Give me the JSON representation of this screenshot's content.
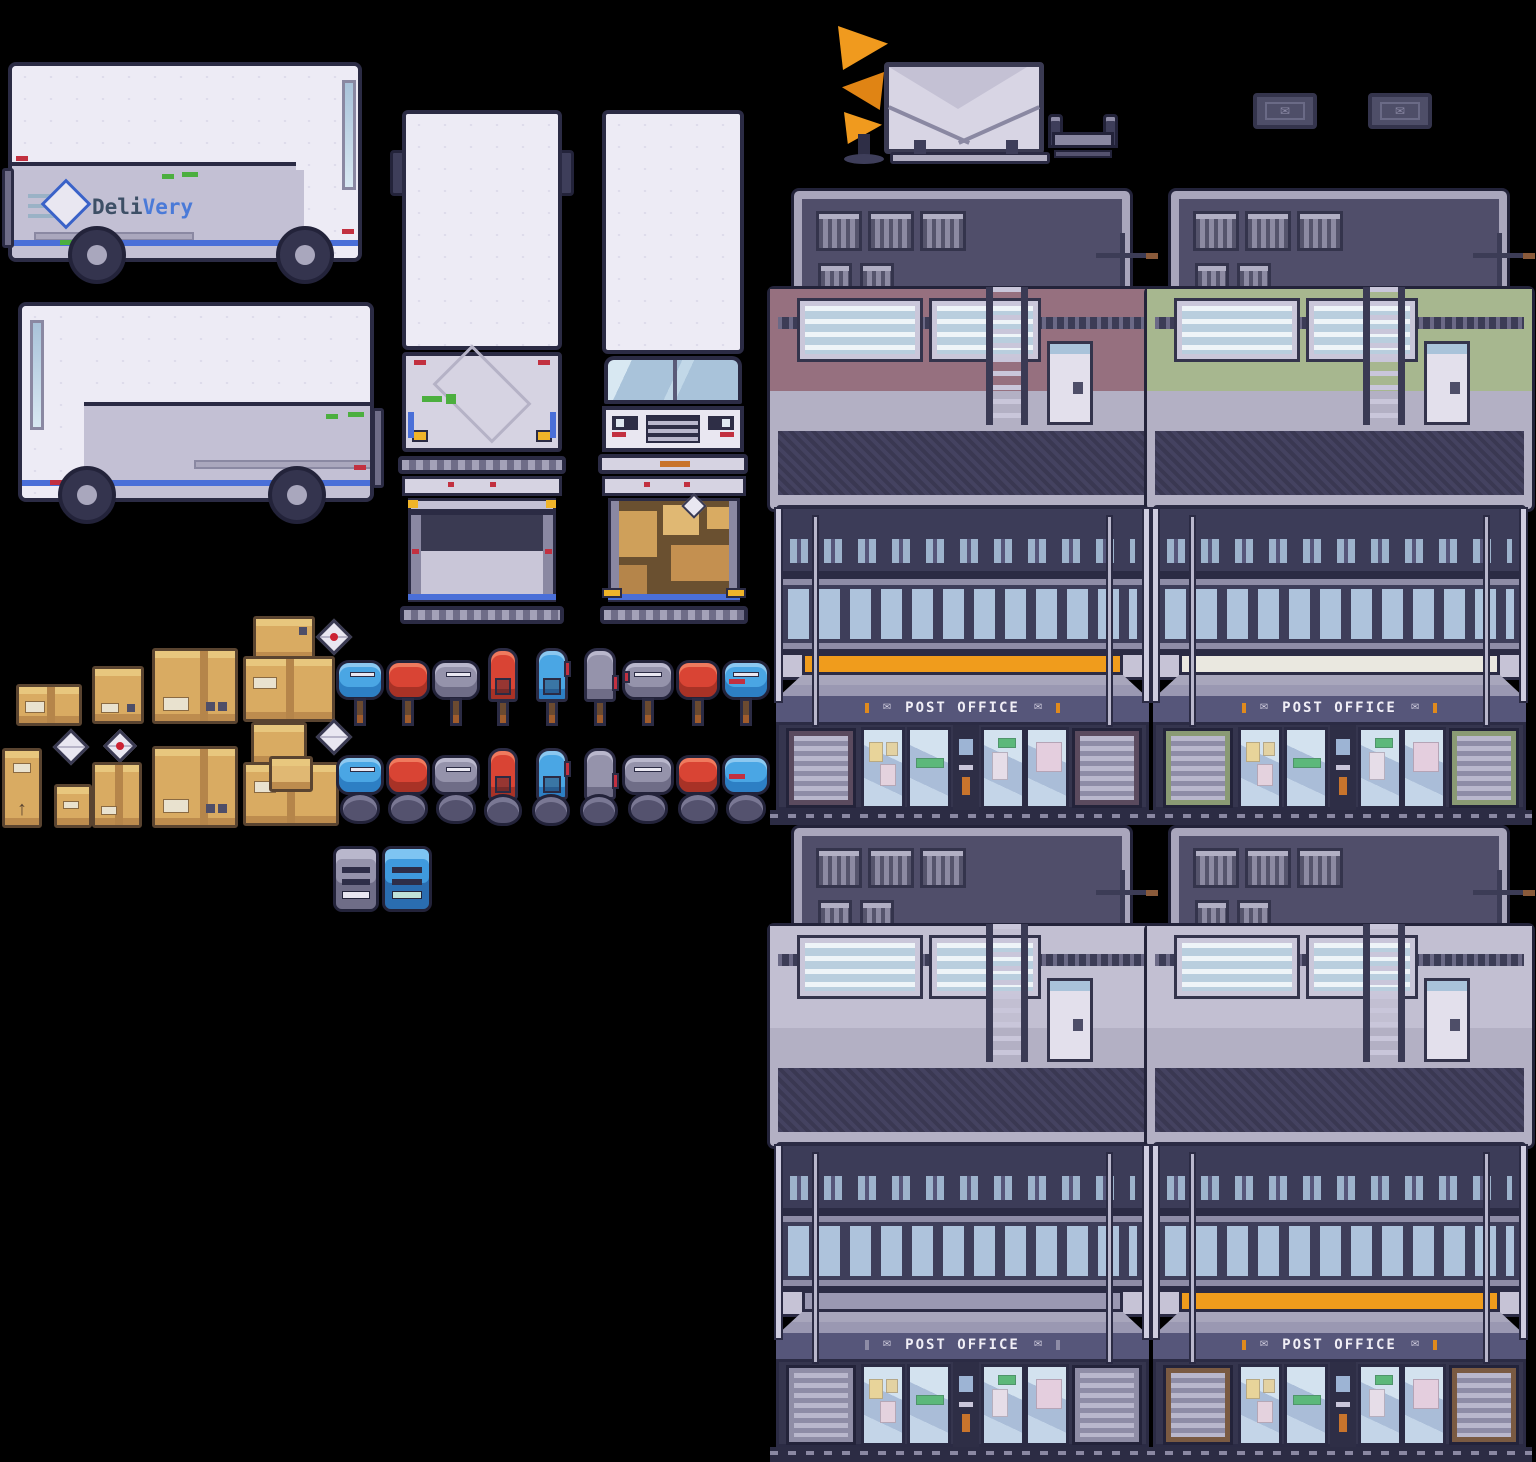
{
  "scene": {
    "description": "pixel-art sprite sheet: delivery trucks, post offices, mailboxes, parcels",
    "background": "#000000"
  },
  "truck_logo": {
    "part1": "Deli",
    "part2": "Very",
    "color1": "#3d4f66",
    "color2": "#4a7ad8"
  },
  "post_office": {
    "sign": "POST OFFICE",
    "sign_color": "#f0eef6"
  },
  "icons": {
    "envelope": "✉",
    "arrow_up": "↑"
  },
  "palette": {
    "outline": "#2b2b44",
    "truck_white": "#edebf5",
    "truck_panel": "#c3c0d4",
    "stripe_blue": "#4a6fd8",
    "glass_blue": "#aec3dc",
    "roof_slate": "#504e6a",
    "frame_light": "#b3b0c4",
    "wall_mauve": "#96707f",
    "wall_sage": "#a7b78f",
    "wall_plain": "#c2bfd2",
    "stripe_orange": "#f09c1c",
    "stripe_cream": "#eae8e0",
    "stripe_gray": "#9a98b2",
    "cardboard": "#d9ab62",
    "mailbox_blue": "#4aa6e4",
    "mailbox_red": "#d94434",
    "mailbox_gray": "#9593ab",
    "horn_orange": "#f09a1e",
    "rust": "#a05c2c"
  },
  "sprites": [
    "delivery-truck-side-right",
    "delivery-truck-side-left",
    "truck-rear-closed",
    "truck-front",
    "truck-rear-open-empty",
    "truck-rear-open-packages",
    "horn-statue",
    "envelope-signboard",
    "parcel-cart",
    "doormat-envelope",
    "post-office-building-mauve",
    "post-office-building-sage",
    "post-office-building-plain",
    "post-office-building-rust",
    "cardboard-boxes",
    "parcel-stacks",
    "letter-envelopes",
    "mailbox-row-posts",
    "mailbox-row-stone-bases",
    "mailbox-topdown-gray",
    "mailbox-topdown-blue"
  ]
}
